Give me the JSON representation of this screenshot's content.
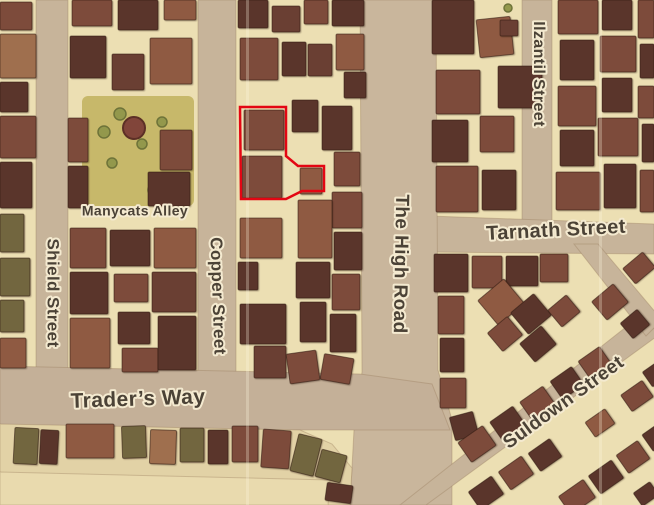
{
  "map": {
    "labels": [
      {
        "id": "manycats-alley",
        "text": "Manycats Alley",
        "x": 135,
        "y": 212,
        "rotate": 0,
        "size": 14
      },
      {
        "id": "shield-street",
        "text": "Shield Street",
        "x": 52,
        "y": 293,
        "rotate": 90,
        "size": 17
      },
      {
        "id": "copper-street",
        "text": "Copper Street",
        "x": 217,
        "y": 296,
        "rotate": 88,
        "size": 17
      },
      {
        "id": "the-high-road",
        "text": "The High Road",
        "x": 400,
        "y": 264,
        "rotate": 91,
        "size": 19
      },
      {
        "id": "ilzantil-street",
        "text": "Ilzantil Street",
        "x": 538,
        "y": 74,
        "rotate": 90,
        "size": 16
      },
      {
        "id": "tarnath-street",
        "text": "Tarnath Street",
        "x": 556,
        "y": 231,
        "rotate": -3,
        "size": 20
      },
      {
        "id": "traders-way",
        "text": "Trader’s Way",
        "x": 138,
        "y": 400,
        "rotate": -2,
        "size": 21
      },
      {
        "id": "suldown-street",
        "text": "Suldown Street",
        "x": 564,
        "y": 403,
        "rotate": -36,
        "size": 19
      }
    ],
    "colors": {
      "courtyard": "#ecdfb3",
      "street": "#c7b49a",
      "plaza": "#e2d2a6",
      "park_ground": "#c7b86a",
      "bush": "#93984c",
      "bush_stroke": "#6e7339",
      "tree": "#81453a",
      "tree_stroke": "#5c2f26",
      "palette": [
        "#6a3f33",
        "#7d4b3b",
        "#8f5a42",
        "#9f6f4e",
        "#72663f",
        "#5a352b",
        "#a8885f"
      ],
      "building_stroke": "rgba(46,23,15,0.55)",
      "label_fill": "#4b4236",
      "label_halo": "#f4ead0",
      "highlight": "#e30613",
      "crease": "rgba(255,248,228,0.28)"
    },
    "streets": [
      {
        "id": "shield-street",
        "rect": [
          36,
          0,
          32,
          428
        ]
      },
      {
        "id": "copper-street",
        "rect": [
          198,
          0,
          38,
          428
        ]
      },
      {
        "id": "ilzantil-street",
        "rect": [
          522,
          0,
          30,
          250
        ]
      },
      {
        "id": "tarnath-street",
        "points": "430,216 654,224 654,254 430,252"
      },
      {
        "id": "the-high-road",
        "points": "360,0 436,0 438,370 452,420 452,505 350,505 354,430 362,372",
        "fill": "#c9b69c"
      },
      {
        "id": "traders-way",
        "points": "0,366 360,374 432,384 450,430 0,430",
        "fill": "#c4b098"
      },
      {
        "id": "suldown-street",
        "points": "400,505 640,316 660,334 426,505"
      },
      {
        "id": "tarnath-suldown-connector",
        "points": "574,244 598,244 662,320 646,336"
      },
      {
        "id": "market-plaza",
        "points": "0,424 300,430 332,444 352,468 350,505 0,505",
        "fill": "#e2d2a6"
      },
      {
        "id": "market-plaza-light",
        "points": "0,472 330,480 328,505 0,505",
        "fill": "#e9daae"
      }
    ],
    "park": {
      "ground": [
        82,
        96,
        112,
        110
      ],
      "tree": {
        "cx": 134,
        "cy": 128,
        "r": 11
      },
      "bushes": [
        [
          104,
          132,
          6
        ],
        [
          120,
          114,
          6
        ],
        [
          162,
          122,
          5
        ],
        [
          142,
          144,
          5
        ],
        [
          112,
          163,
          5
        ],
        [
          154,
          190,
          6
        ],
        [
          508,
          8,
          4
        ],
        [
          494,
          44,
          4
        ]
      ]
    },
    "buildings": [
      [
        0,
        2,
        32,
        28,
        1
      ],
      [
        0,
        34,
        36,
        44,
        3
      ],
      [
        0,
        82,
        28,
        30,
        5
      ],
      [
        0,
        116,
        36,
        42,
        1
      ],
      [
        0,
        162,
        32,
        46,
        5
      ],
      [
        0,
        214,
        24,
        38,
        4
      ],
      [
        0,
        258,
        30,
        38,
        4
      ],
      [
        0,
        300,
        24,
        32,
        4
      ],
      [
        0,
        338,
        26,
        30,
        2
      ],
      [
        72,
        0,
        40,
        26,
        1
      ],
      [
        118,
        0,
        40,
        30,
        5
      ],
      [
        164,
        0,
        32,
        20,
        2
      ],
      [
        70,
        36,
        36,
        42,
        5
      ],
      [
        112,
        54,
        32,
        36,
        0
      ],
      [
        150,
        38,
        42,
        46,
        2
      ],
      [
        68,
        118,
        20,
        44,
        1
      ],
      [
        68,
        166,
        20,
        42,
        5
      ],
      [
        160,
        130,
        32,
        40,
        1
      ],
      [
        148,
        172,
        42,
        34,
        5
      ],
      [
        70,
        228,
        36,
        40,
        1
      ],
      [
        110,
        230,
        40,
        36,
        5
      ],
      [
        154,
        228,
        42,
        40,
        2
      ],
      [
        70,
        272,
        38,
        42,
        5
      ],
      [
        114,
        274,
        34,
        28,
        1
      ],
      [
        152,
        272,
        44,
        40,
        0
      ],
      [
        70,
        318,
        40,
        50,
        2
      ],
      [
        118,
        312,
        32,
        32,
        5
      ],
      [
        122,
        348,
        36,
        24,
        1
      ],
      [
        158,
        316,
        38,
        54,
        5
      ],
      [
        238,
        0,
        30,
        28,
        5
      ],
      [
        272,
        6,
        28,
        26,
        0
      ],
      [
        304,
        0,
        24,
        24,
        1
      ],
      [
        332,
        0,
        32,
        26,
        5
      ],
      [
        240,
        38,
        38,
        42,
        1
      ],
      [
        282,
        42,
        24,
        34,
        5
      ],
      [
        308,
        44,
        24,
        32,
        0
      ],
      [
        336,
        34,
        28,
        36,
        2
      ],
      [
        344,
        72,
        22,
        26,
        5
      ],
      [
        244,
        110,
        40,
        40,
        1
      ],
      [
        242,
        156,
        40,
        42,
        1
      ],
      [
        300,
        168,
        22,
        26,
        2
      ],
      [
        292,
        100,
        26,
        32,
        5
      ],
      [
        322,
        106,
        30,
        44,
        5
      ],
      [
        334,
        152,
        26,
        34,
        1
      ],
      [
        332,
        192,
        30,
        36,
        1
      ],
      [
        334,
        232,
        28,
        38,
        5
      ],
      [
        332,
        274,
        28,
        36,
        1
      ],
      [
        330,
        314,
        26,
        38,
        5
      ],
      [
        322,
        356,
        30,
        26,
        1,
        10
      ],
      [
        298,
        200,
        34,
        58,
        2
      ],
      [
        296,
        262,
        34,
        36,
        5
      ],
      [
        300,
        302,
        26,
        40,
        5
      ],
      [
        240,
        218,
        42,
        40,
        2
      ],
      [
        238,
        262,
        20,
        28,
        5
      ],
      [
        240,
        304,
        46,
        40,
        5
      ],
      [
        254,
        346,
        32,
        32,
        0
      ],
      [
        288,
        352,
        30,
        30,
        1,
        -8
      ],
      [
        432,
        0,
        42,
        54,
        5
      ],
      [
        478,
        18,
        34,
        38,
        2,
        -6
      ],
      [
        500,
        20,
        18,
        16,
        0
      ],
      [
        436,
        70,
        44,
        44,
        1
      ],
      [
        498,
        66,
        44,
        42,
        5
      ],
      [
        432,
        120,
        36,
        42,
        5
      ],
      [
        480,
        116,
        34,
        36,
        1
      ],
      [
        436,
        166,
        42,
        46,
        1
      ],
      [
        482,
        170,
        34,
        40,
        5
      ],
      [
        558,
        0,
        40,
        34,
        1
      ],
      [
        602,
        0,
        30,
        30,
        5
      ],
      [
        638,
        0,
        16,
        38,
        1
      ],
      [
        560,
        40,
        34,
        40,
        5
      ],
      [
        600,
        36,
        36,
        36,
        1
      ],
      [
        640,
        44,
        14,
        34,
        5
      ],
      [
        558,
        86,
        38,
        40,
        1
      ],
      [
        602,
        78,
        30,
        34,
        5
      ],
      [
        638,
        86,
        16,
        32,
        1
      ],
      [
        560,
        130,
        34,
        36,
        5
      ],
      [
        598,
        118,
        40,
        38,
        1
      ],
      [
        642,
        124,
        12,
        38,
        5
      ],
      [
        556,
        172,
        44,
        38,
        1
      ],
      [
        604,
        164,
        32,
        44,
        5
      ],
      [
        640,
        170,
        14,
        42,
        1
      ],
      [
        434,
        254,
        34,
        38,
        5
      ],
      [
        472,
        256,
        30,
        32,
        1
      ],
      [
        506,
        256,
        32,
        30,
        5
      ],
      [
        540,
        254,
        28,
        28,
        1
      ],
      [
        626,
        258,
        26,
        20,
        1,
        -40
      ],
      [
        596,
        290,
        28,
        24,
        1,
        -40
      ],
      [
        624,
        314,
        22,
        20,
        5,
        -40
      ],
      [
        438,
        296,
        26,
        38,
        1
      ],
      [
        440,
        338,
        24,
        34,
        5
      ],
      [
        440,
        378,
        26,
        30,
        1
      ],
      [
        452,
        414,
        24,
        24,
        5,
        -15
      ],
      [
        484,
        286,
        34,
        32,
        2,
        -40
      ],
      [
        516,
        300,
        30,
        28,
        5,
        -40
      ],
      [
        492,
        322,
        26,
        24,
        1,
        -40
      ],
      [
        524,
        332,
        28,
        24,
        5,
        -40
      ],
      [
        552,
        300,
        24,
        22,
        1,
        -40
      ],
      [
        462,
        432,
        30,
        24,
        1,
        -35
      ],
      [
        494,
        412,
        28,
        24,
        5,
        -35
      ],
      [
        524,
        392,
        28,
        24,
        1,
        -35
      ],
      [
        554,
        372,
        26,
        22,
        5,
        -35
      ],
      [
        582,
        352,
        26,
        22,
        1,
        -35
      ],
      [
        472,
        482,
        28,
        22,
        5,
        -35
      ],
      [
        502,
        462,
        28,
        22,
        1,
        -35
      ],
      [
        532,
        444,
        26,
        22,
        5,
        -35
      ],
      [
        562,
        486,
        30,
        22,
        1,
        -35
      ],
      [
        592,
        466,
        28,
        22,
        5,
        -35
      ],
      [
        620,
        446,
        26,
        22,
        1,
        -35
      ],
      [
        646,
        428,
        18,
        20,
        5,
        -35
      ],
      [
        624,
        386,
        26,
        20,
        1,
        -35
      ],
      [
        646,
        366,
        16,
        18,
        5,
        -35
      ],
      [
        636,
        486,
        20,
        16,
        5,
        -35
      ],
      [
        588,
        414,
        24,
        18,
        2,
        -35
      ],
      [
        318,
        452,
        26,
        28,
        4,
        15
      ],
      [
        326,
        484,
        26,
        18,
        5,
        8
      ]
    ],
    "stalls": [
      [
        14,
        428,
        24,
        36,
        4,
        3
      ],
      [
        40,
        430,
        18,
        34,
        5,
        3
      ],
      [
        66,
        424,
        48,
        34,
        2,
        0
      ],
      [
        122,
        426,
        24,
        32,
        4,
        -2
      ],
      [
        150,
        430,
        26,
        34,
        3,
        2
      ],
      [
        180,
        428,
        24,
        34,
        4,
        0
      ],
      [
        208,
        430,
        20,
        34,
        5,
        0
      ],
      [
        232,
        426,
        26,
        36,
        1,
        0
      ],
      [
        262,
        430,
        28,
        38,
        1,
        4
      ],
      [
        294,
        436,
        24,
        38,
        4,
        14
      ]
    ],
    "highlight": {
      "points": "240,107 286,107 286,156 298,166 324,166 324,191 302,191 286,199 241,199",
      "width": 2.5
    },
    "creases": [
      {
        "x": 246
      },
      {
        "x": 599
      }
    ]
  }
}
